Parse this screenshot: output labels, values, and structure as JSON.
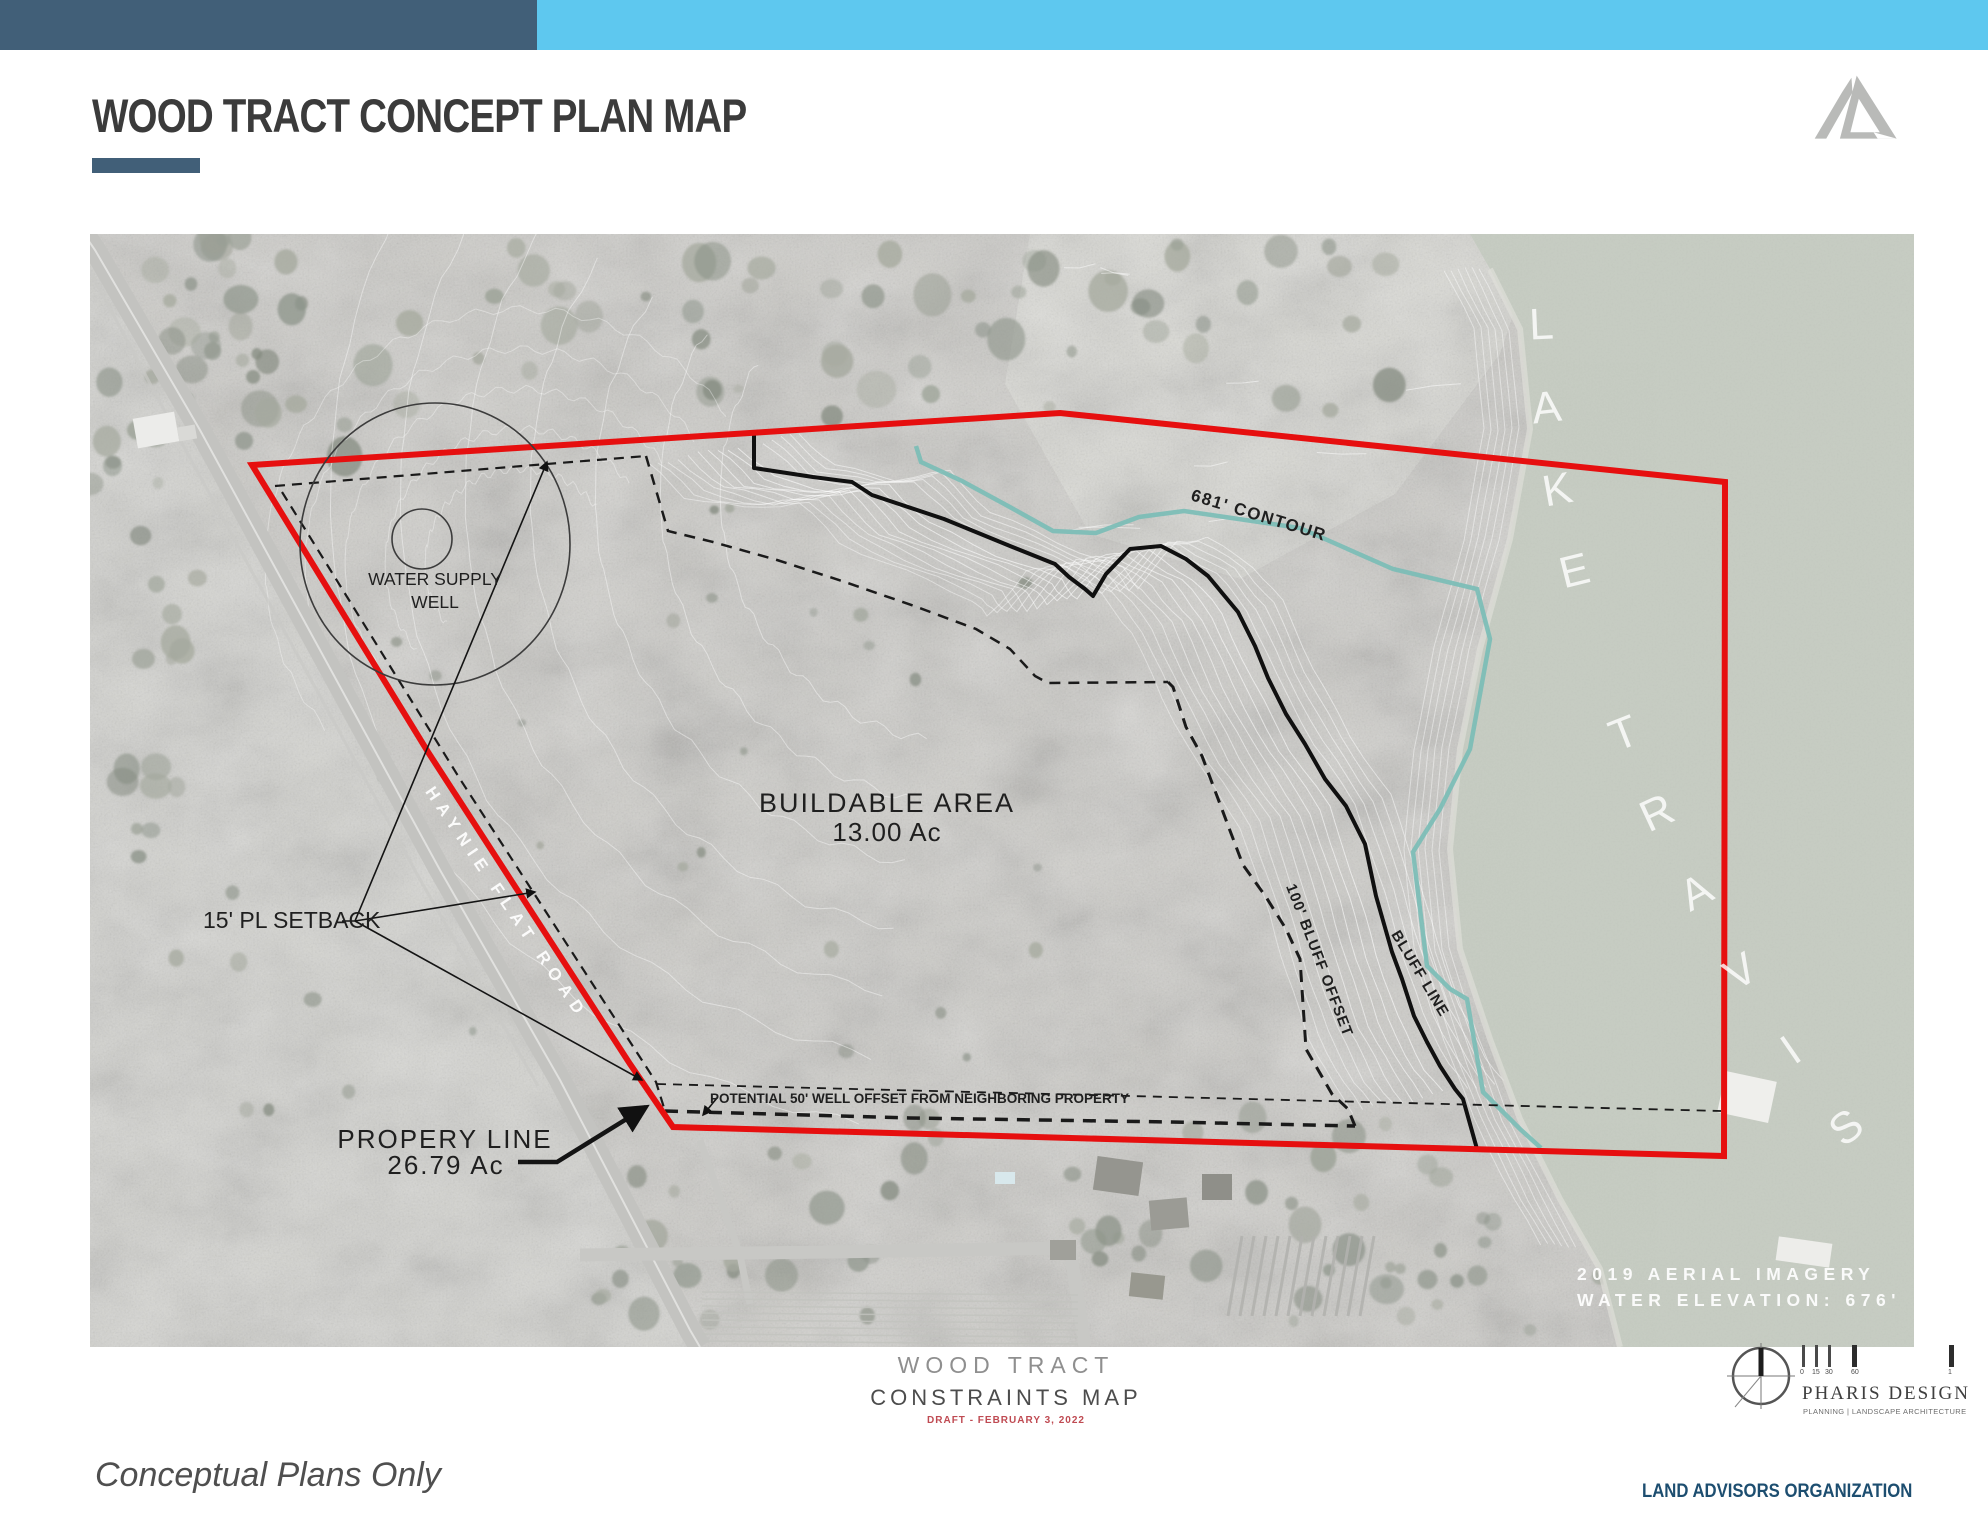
{
  "header": {
    "title": "WOOD TRACT CONCEPT PLAN MAP"
  },
  "map": {
    "labels": {
      "water_well_line1": "WATER SUPPLY",
      "water_well_line2": "WELL",
      "contour": "681' CONTOUR",
      "buildable_line1": "BUILDABLE AREA",
      "buildable_line2": "13.00 Ac",
      "setback": "15' PL SETBACK",
      "property_line1": "PROPERY LINE",
      "property_line2": "26.79 Ac",
      "well_offset": "POTENTIAL 50' WELL OFFSET FROM NEIGHBORING PROPERTY",
      "bluff_offset": "100' BLUFF OFFSET",
      "bluff_line": "BLUFF LINE",
      "road": "HAYNIE FLAT ROAD",
      "lake": "LAKE TRAVIS",
      "aerial_line1": "2019 AERIAL IMAGERY",
      "aerial_line2": "WATER ELEVATION: 676'"
    }
  },
  "title_block": {
    "line1": "WOOD TRACT",
    "line2": "CONSTRAINTS MAP",
    "line3": "DRAFT - FEBRUARY 3, 2022"
  },
  "pharis": {
    "name": "PHARIS DESIGN",
    "tagline": "PLANNING | LANDSCAPE ARCHITECTURE",
    "scale_ticks": [
      "0",
      "15",
      "30",
      "60",
      "1"
    ]
  },
  "footer": {
    "disclaimer": "Conceptual Plans Only",
    "company": "LAND ADVISORS ORGANIZATION"
  },
  "colors": {
    "accent_dark": "#415f78",
    "accent_light": "#5ec8ef",
    "boundary_red": "#e60f0f",
    "contour_teal": "#79bdb6",
    "draft_red": "#bf4a52",
    "water": "#c6ccc2"
  }
}
